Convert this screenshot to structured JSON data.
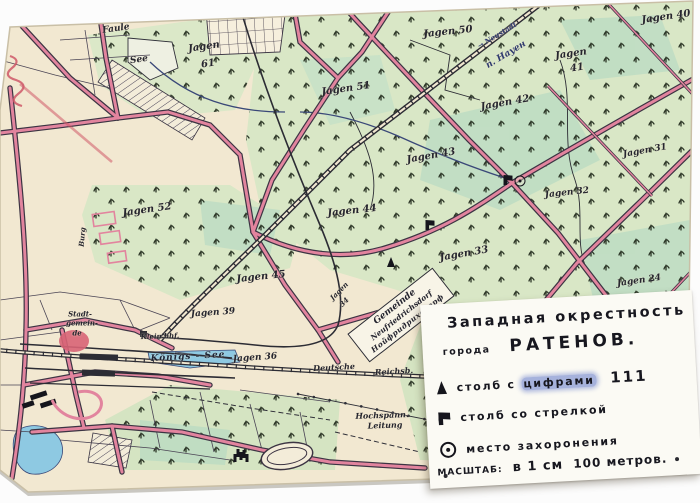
{
  "legend": {
    "title": "Западная окрестность",
    "city_prefix": "города",
    "city_name": "РАТЕНОВ.",
    "items": [
      {
        "icon": "post-with-numbers-triangle-icon",
        "label_pre": "столб с",
        "label_smudged": "цифрами",
        "value": "111"
      },
      {
        "icon": "post-with-arrow-flag-icon",
        "label": "столб со стрелкой"
      },
      {
        "icon": "burial-place-circle-icon",
        "label": "место захоронения"
      }
    ],
    "scale_label": "МАСШТАБ:",
    "scale_cm": "в 1 см",
    "scale_m": "100 метров."
  },
  "map": {
    "gemeinde_box": {
      "line1": "Gemeinde",
      "line2": "Neufriedrichsdorf",
      "line3": "Нойфридрихсдорф"
    },
    "labels": [
      {
        "text": "Faule",
        "x": 116,
        "y": 29,
        "r": -8,
        "s": 9
      },
      {
        "text": "See",
        "x": 139,
        "y": 60,
        "r": -8,
        "s": 9
      },
      {
        "text": "Jagen",
        "x": 204,
        "y": 47,
        "r": -8,
        "s": 10
      },
      {
        "text": "61",
        "x": 208,
        "y": 64,
        "r": -8,
        "s": 10
      },
      {
        "text": "Jagen 50",
        "x": 448,
        "y": 32,
        "r": -6,
        "s": 10
      },
      {
        "text": "→ Neustadt",
        "x": 497,
        "y": 35,
        "r": -31,
        "s": 7,
        "c": "ink"
      },
      {
        "text": "п. Науен",
        "x": 506,
        "y": 55,
        "r": -31,
        "s": 9,
        "c": "ink"
      },
      {
        "text": "Jagen 40",
        "x": 666,
        "y": 17,
        "r": -8,
        "s": 10
      },
      {
        "text": "Jagen 51",
        "x": 346,
        "y": 89,
        "r": -8,
        "s": 10
      },
      {
        "text": "Jagen",
        "x": 571,
        "y": 54,
        "r": -8,
        "s": 10
      },
      {
        "text": "41",
        "x": 577,
        "y": 68,
        "r": -8,
        "s": 10
      },
      {
        "text": "Jagen 42",
        "x": 505,
        "y": 103,
        "r": -10,
        "s": 10
      },
      {
        "text": "Jagen 43",
        "x": 431,
        "y": 156,
        "r": -10,
        "s": 10
      },
      {
        "text": "Jagen 31",
        "x": 645,
        "y": 151,
        "r": -10,
        "s": 9
      },
      {
        "text": "Jagen 32",
        "x": 567,
        "y": 193,
        "r": -6,
        "s": 9
      },
      {
        "text": "Jagen 44",
        "x": 352,
        "y": 211,
        "r": -6,
        "s": 10
      },
      {
        "text": "Jagen 33",
        "x": 464,
        "y": 254,
        "r": -10,
        "s": 10
      },
      {
        "text": "Jagen 24",
        "x": 639,
        "y": 281,
        "r": -8,
        "s": 9
      },
      {
        "text": "Jagen 52",
        "x": 147,
        "y": 210,
        "r": -8,
        "s": 10
      },
      {
        "text": "Jagen 45",
        "x": 261,
        "y": 277,
        "r": -6,
        "s": 10
      },
      {
        "text": "Jagen 39",
        "x": 213,
        "y": 313,
        "r": -4,
        "s": 9
      },
      {
        "text": "Jagen",
        "x": 339,
        "y": 291,
        "r": -45,
        "s": 7
      },
      {
        "text": "34",
        "x": 344,
        "y": 302,
        "r": -45,
        "s": 7
      },
      {
        "text": "Jagen 36",
        "x": 255,
        "y": 358,
        "r": -4,
        "s": 9
      },
      {
        "text": "Königs - See",
        "x": 188,
        "y": 357,
        "r": -3,
        "s": 9,
        "c": "water"
      },
      {
        "text": "Deutsche",
        "x": 334,
        "y": 367,
        "r": -3,
        "s": 8
      },
      {
        "text": "Reichsb.",
        "x": 394,
        "y": 371,
        "r": -3,
        "s": 8
      },
      {
        "text": "Klein bhf.",
        "x": 160,
        "y": 336,
        "r": -2,
        "s": 7
      },
      {
        "text": "Hochspann.",
        "x": 382,
        "y": 415,
        "r": -2,
        "s": 8
      },
      {
        "text": "Leitung",
        "x": 385,
        "y": 425,
        "r": -2,
        "s": 8
      },
      {
        "text": "Stadt-",
        "x": 80,
        "y": 314,
        "r": 0,
        "s": 7
      },
      {
        "text": "gemein-",
        "x": 82,
        "y": 323,
        "r": 0,
        "s": 7
      },
      {
        "text": "de",
        "x": 77,
        "y": 333,
        "r": 0,
        "s": 7
      },
      {
        "text": "Burg",
        "x": 82,
        "y": 237,
        "r": -85,
        "s": 7
      }
    ],
    "markers": [
      {
        "type": "flag",
        "x": 430,
        "y": 225
      },
      {
        "type": "triangle",
        "x": 391,
        "y": 262
      },
      {
        "type": "flag",
        "x": 508,
        "y": 180
      },
      {
        "type": "burial",
        "x": 520,
        "y": 181
      },
      {
        "type": "site",
        "x": 241,
        "y": 456
      }
    ]
  },
  "colors": {
    "paper": "#f2e8d1",
    "forest_light": "#d9e7c6",
    "forest_teal": "#aed7c2",
    "water": "#8ec9e2",
    "road_pink": "#e2849e",
    "road_outline": "#3c3443",
    "railway": "#2c2c34",
    "ink_navy": "#2e3a6e",
    "red_pencil": "#cf5868",
    "blue_pencil": "#3353c4",
    "card": "#fbfaf4"
  }
}
